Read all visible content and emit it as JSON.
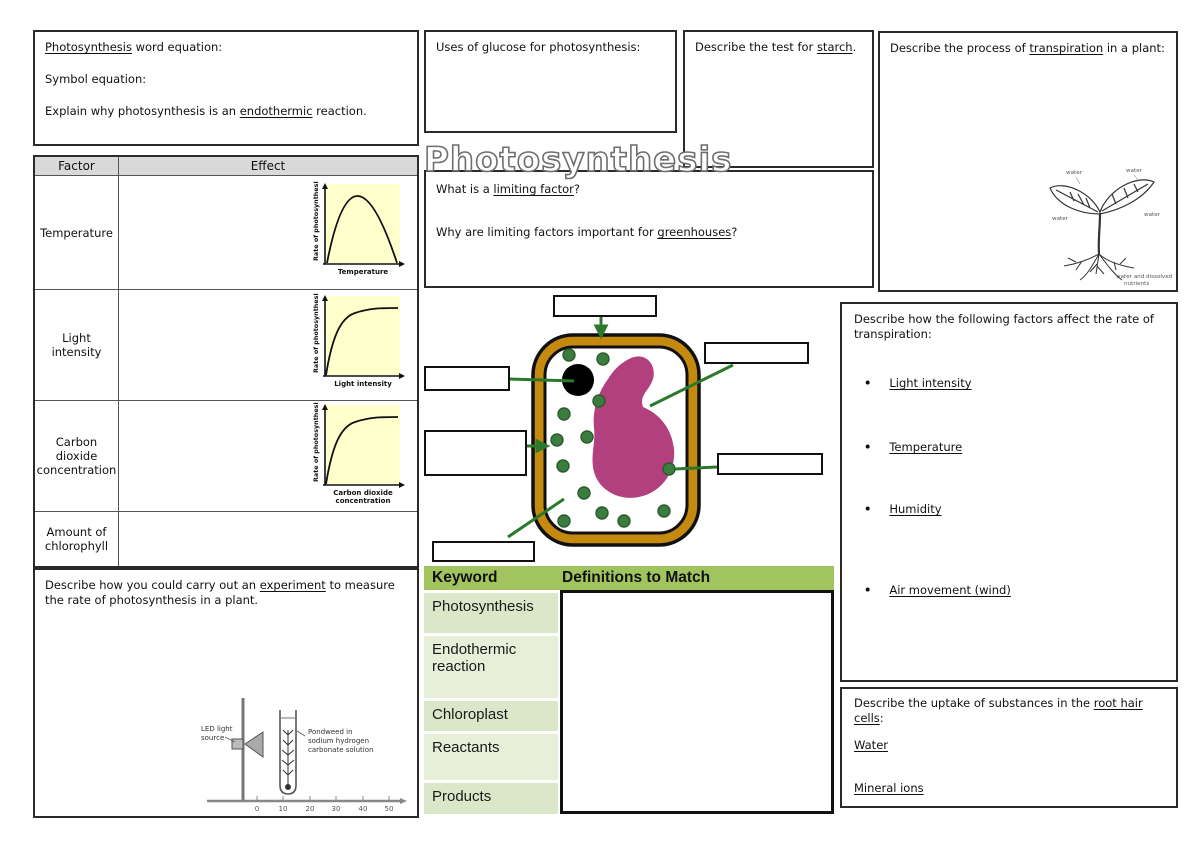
{
  "title": "Photosynthesis",
  "colors": {
    "graph_bg": "#FFFFCC",
    "table_header_gray": "#D9D9D9",
    "keyword_header_green": "#A2C45E",
    "keyword_row_green": "#DBE7C9",
    "keyword_row_green_alt": "#E7EFD9",
    "cell_wall_gold": "#C6890F",
    "vacuole_magenta": "#B23F7E",
    "chloroplast_green": "#3B7C3F",
    "arrow_green": "#2B7A2B"
  },
  "equations_box": {
    "lines": [
      [
        {
          "t": "Photosynthesis",
          "u": true
        },
        {
          "t": " word equation:"
        }
      ],
      [
        {
          "t": "Symbol equation:"
        }
      ],
      [
        {
          "t": "Explain why photosynthesis is an "
        },
        {
          "t": "endothermic",
          "u": true
        },
        {
          "t": " reaction."
        }
      ]
    ]
  },
  "factor_table": {
    "header": {
      "factor": "Factor",
      "effect": "Effect"
    },
    "rows": [
      {
        "factor": "Temperature"
      },
      {
        "factor": "Light intensity"
      },
      {
        "factor": "Carbon dioxide concentration"
      },
      {
        "factor": "Amount of chlorophyll"
      }
    ],
    "graphs": [
      {
        "ylabel": "Rate of photosynthesis",
        "xlabel_lines": [
          "Temperature"
        ],
        "curve": "rises to a peak then falls"
      },
      {
        "ylabel": "Rate of photosynthesis",
        "xlabel_lines": [
          "Light intensity"
        ],
        "curve": "rises then plateaus"
      },
      {
        "ylabel": "Rate of photosynthesis",
        "xlabel_lines": [
          "Carbon dioxide",
          "concentration"
        ],
        "curve": "rises then plateaus"
      }
    ]
  },
  "experiment_box": {
    "prompt": [
      {
        "t": "Describe how you could carry out an "
      },
      {
        "t": "experiment",
        "u": true
      },
      {
        "t": " to measure the rate of photosynthesis in a plant."
      }
    ],
    "diagram": {
      "led_label_lines": [
        "LED light",
        "source"
      ],
      "pondweed_label_lines": [
        "Pondweed in",
        "sodium hydrogen",
        "carbonate solution"
      ],
      "ruler_ticks": [
        "0",
        "10",
        "20",
        "30",
        "40",
        "50"
      ]
    }
  },
  "glucose_box": {
    "prompt": "Uses of glucose for photosynthesis:"
  },
  "limiting_box": {
    "q1": [
      {
        "t": "What is a "
      },
      {
        "t": "limiting factor",
        "u": true
      },
      {
        "t": "?"
      }
    ],
    "q2": [
      {
        "t": "Why are limiting factors important for "
      },
      {
        "t": "greenhouses",
        "u": true
      },
      {
        "t": "?"
      }
    ]
  },
  "starch_box": {
    "prompt": [
      {
        "t": "Describe the test for "
      },
      {
        "t": "starch",
        "u": true
      },
      {
        "t": "."
      }
    ]
  },
  "transpiration_box": {
    "prompt": [
      {
        "t": "Describe the process of "
      },
      {
        "t": "transpiration",
        "u": true
      },
      {
        "t": " in a plant:"
      }
    ],
    "plant": {
      "water_label": "water",
      "roots_label_lines": [
        "water and dissolved",
        "nutrients"
      ]
    }
  },
  "factors_box": {
    "prompt": "Describe how the following factors affect the rate of transpiration:",
    "bullet_glyph": "•",
    "bullets": [
      "Light intensity",
      "Temperature",
      "Humidity",
      "Air movement (wind)"
    ]
  },
  "roothair_box": {
    "prompt": [
      {
        "t": "Describe the uptake of substances in the "
      },
      {
        "t": "root hair cells",
        "u": true
      },
      {
        "t": ":"
      }
    ],
    "items": [
      "Water",
      "Mineral ions"
    ]
  },
  "keyword_table": {
    "header": [
      "Keyword",
      "Definitions to Match"
    ],
    "keywords": [
      "Photosynthesis",
      "Endothermic reaction",
      "Chloroplast",
      "Reactants",
      "Products"
    ]
  }
}
